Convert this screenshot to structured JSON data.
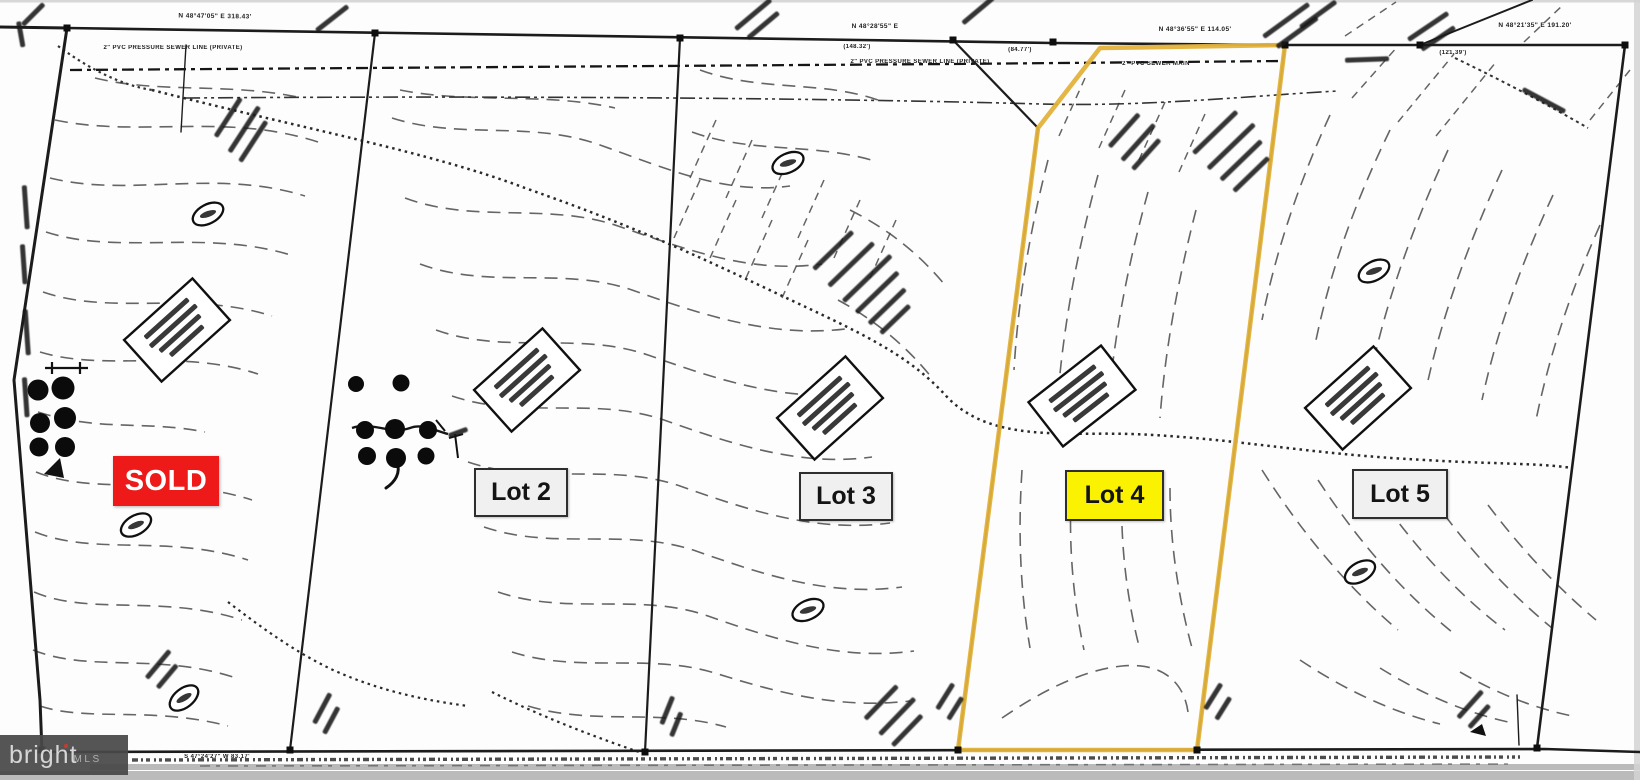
{
  "labels": {
    "sold": "SOLD",
    "lot2": "Lot 2",
    "lot3": "Lot 3",
    "lot4": "Lot 4",
    "lot5": "Lot 5"
  },
  "annotations": {
    "bearing_top_left": "N 48°47'05\" E   318.43'",
    "bearing_top_mid": "N 48°28'55\" E",
    "dim_mid_1": "(148.32')",
    "dim_mid_2": "(84.77')",
    "bearing_top_lot4": "N 48°36'55\" E   114.05'",
    "bearing_top_right": "N 48°21'35\" E   191.20'",
    "dim_right": "(121.39')",
    "sewer_pressure_left": "2\" PVC PRESSURE SEWER LINE  (PRIVATE)",
    "sewer_pressure_mid": "2\" PVC PRESSURE SEWER LINE (PRIVATE)",
    "sewer_main": "2\" PVC SEWER MAIN",
    "bearing_road": "S 47°24'27\" W   83.17'"
  },
  "watermark": {
    "brand": "bright",
    "suffix": "MLS"
  },
  "colors": {
    "boundary_highlight": "#E3B23B",
    "lot4_label_bg": "#FAF200",
    "sold_bg": "#EE1A1A",
    "label_bg": "#F0F0F0",
    "ink": "#1C1C1C",
    "contour": "#4A4A4A"
  }
}
